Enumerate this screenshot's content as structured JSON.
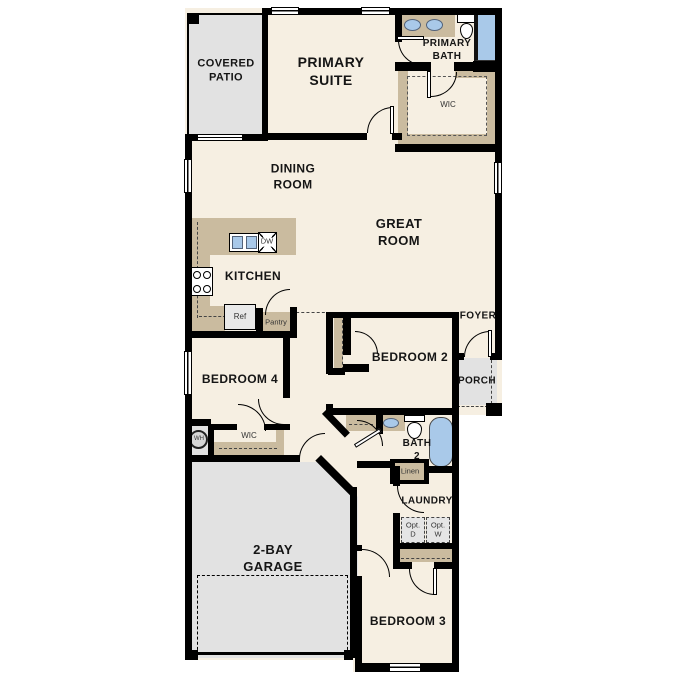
{
  "plan": {
    "rooms": {
      "covered_patio": "COVERED\nPATIO",
      "primary_suite": "PRIMARY\nSUITE",
      "primary_bath": "PRIMARY\nBATH",
      "primary_wic": "WIC",
      "dining_room": "DINING\nROOM",
      "great_room": "GREAT\nROOM",
      "kitchen": "KITCHEN",
      "foyer": "FOYER",
      "porch": "PORCH",
      "bedroom2": "BEDROOM 2",
      "bedroom3": "BEDROOM 3",
      "bedroom4": "BEDROOM 4",
      "bedroom4_wic": "WIC",
      "bath2": "BATH\n2",
      "laundry": "LAUNDRY",
      "garage": "2-BAY\nGARAGE"
    },
    "fixture_labels": {
      "refrigerator": "Ref",
      "pantry": "Pantry",
      "dishwasher": "DW",
      "linen": "Linen",
      "water_heater": "WH",
      "optional_dryer": "Opt.\nD",
      "optional_washer": "Opt.\nW"
    },
    "colors": {
      "floor": "#f6efe2",
      "outdoor_concrete": "#e2e2e2",
      "casework_tan": "#cabb9f",
      "fixture_blue": "#a9c9e9",
      "wall": "#000000"
    }
  }
}
